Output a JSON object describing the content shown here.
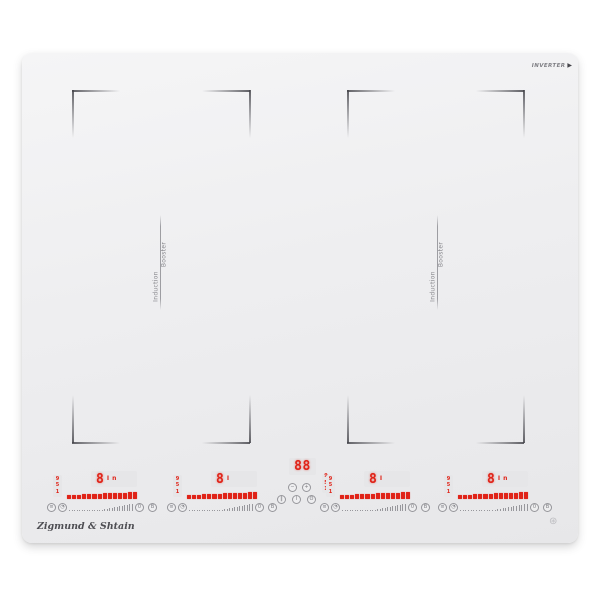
{
  "colors": {
    "led_red": "#e02318",
    "display_bg": "#e6e6e8",
    "icon_gray": "#7d7d82",
    "panel": "#eeeef0"
  },
  "branding": {
    "maker_logo": "Zigmund & Shtain",
    "tech_badge": "INVERTER",
    "badge_arrow_icon": "▶",
    "emblem_icon": "⊛"
  },
  "flex_zones": {
    "left_divider": {
      "label_a": "Induction",
      "label_b": "Booster"
    },
    "right_divider": {
      "label_a": "Induction",
      "label_b": "Booster"
    }
  },
  "controls": {
    "zones": [
      {
        "id": "zone-1",
        "level": "8",
        "indicators": [
          "I",
          "n"
        ],
        "scale_marks": [
          "9",
          "5",
          "1"
        ],
        "power_segments": 14,
        "slider": {
          "tick_count": 26,
          "buttons": {
            "a": "≡",
            "b": "◔",
            "c": "0",
            "d": "B"
          }
        }
      },
      {
        "id": "zone-2",
        "level": "8",
        "indicators": [
          "I"
        ],
        "scale_marks": [
          "9",
          "5",
          "1"
        ],
        "power_segments": 14,
        "slider": {
          "tick_count": 26,
          "buttons": {
            "a": "≡",
            "b": "◔",
            "c": "0",
            "d": "B"
          }
        }
      },
      {
        "id": "zone-3",
        "level": "8",
        "indicators": [
          "I"
        ],
        "scale_marks": [
          "9",
          "5",
          "1"
        ],
        "power_segments": 14,
        "slider": {
          "tick_count": 26,
          "buttons": {
            "a": "≡",
            "b": "◔",
            "c": "0",
            "d": "B"
          }
        }
      },
      {
        "id": "zone-4",
        "level": "8",
        "indicators": [
          "I",
          "n"
        ],
        "scale_marks": [
          "9",
          "5",
          "1"
        ],
        "power_segments": 14,
        "slider": {
          "tick_count": 26,
          "buttons": {
            "a": "≡",
            "b": "◔",
            "c": "0",
            "d": "B"
          }
        }
      }
    ],
    "timer": {
      "display": "88",
      "scale_marks": [
        "9",
        "5",
        "1"
      ],
      "minus_icon": "−",
      "plus_icon": "+",
      "pause_icon": "‖",
      "power_icon": "I",
      "lock_icon": "ʘ"
    }
  }
}
